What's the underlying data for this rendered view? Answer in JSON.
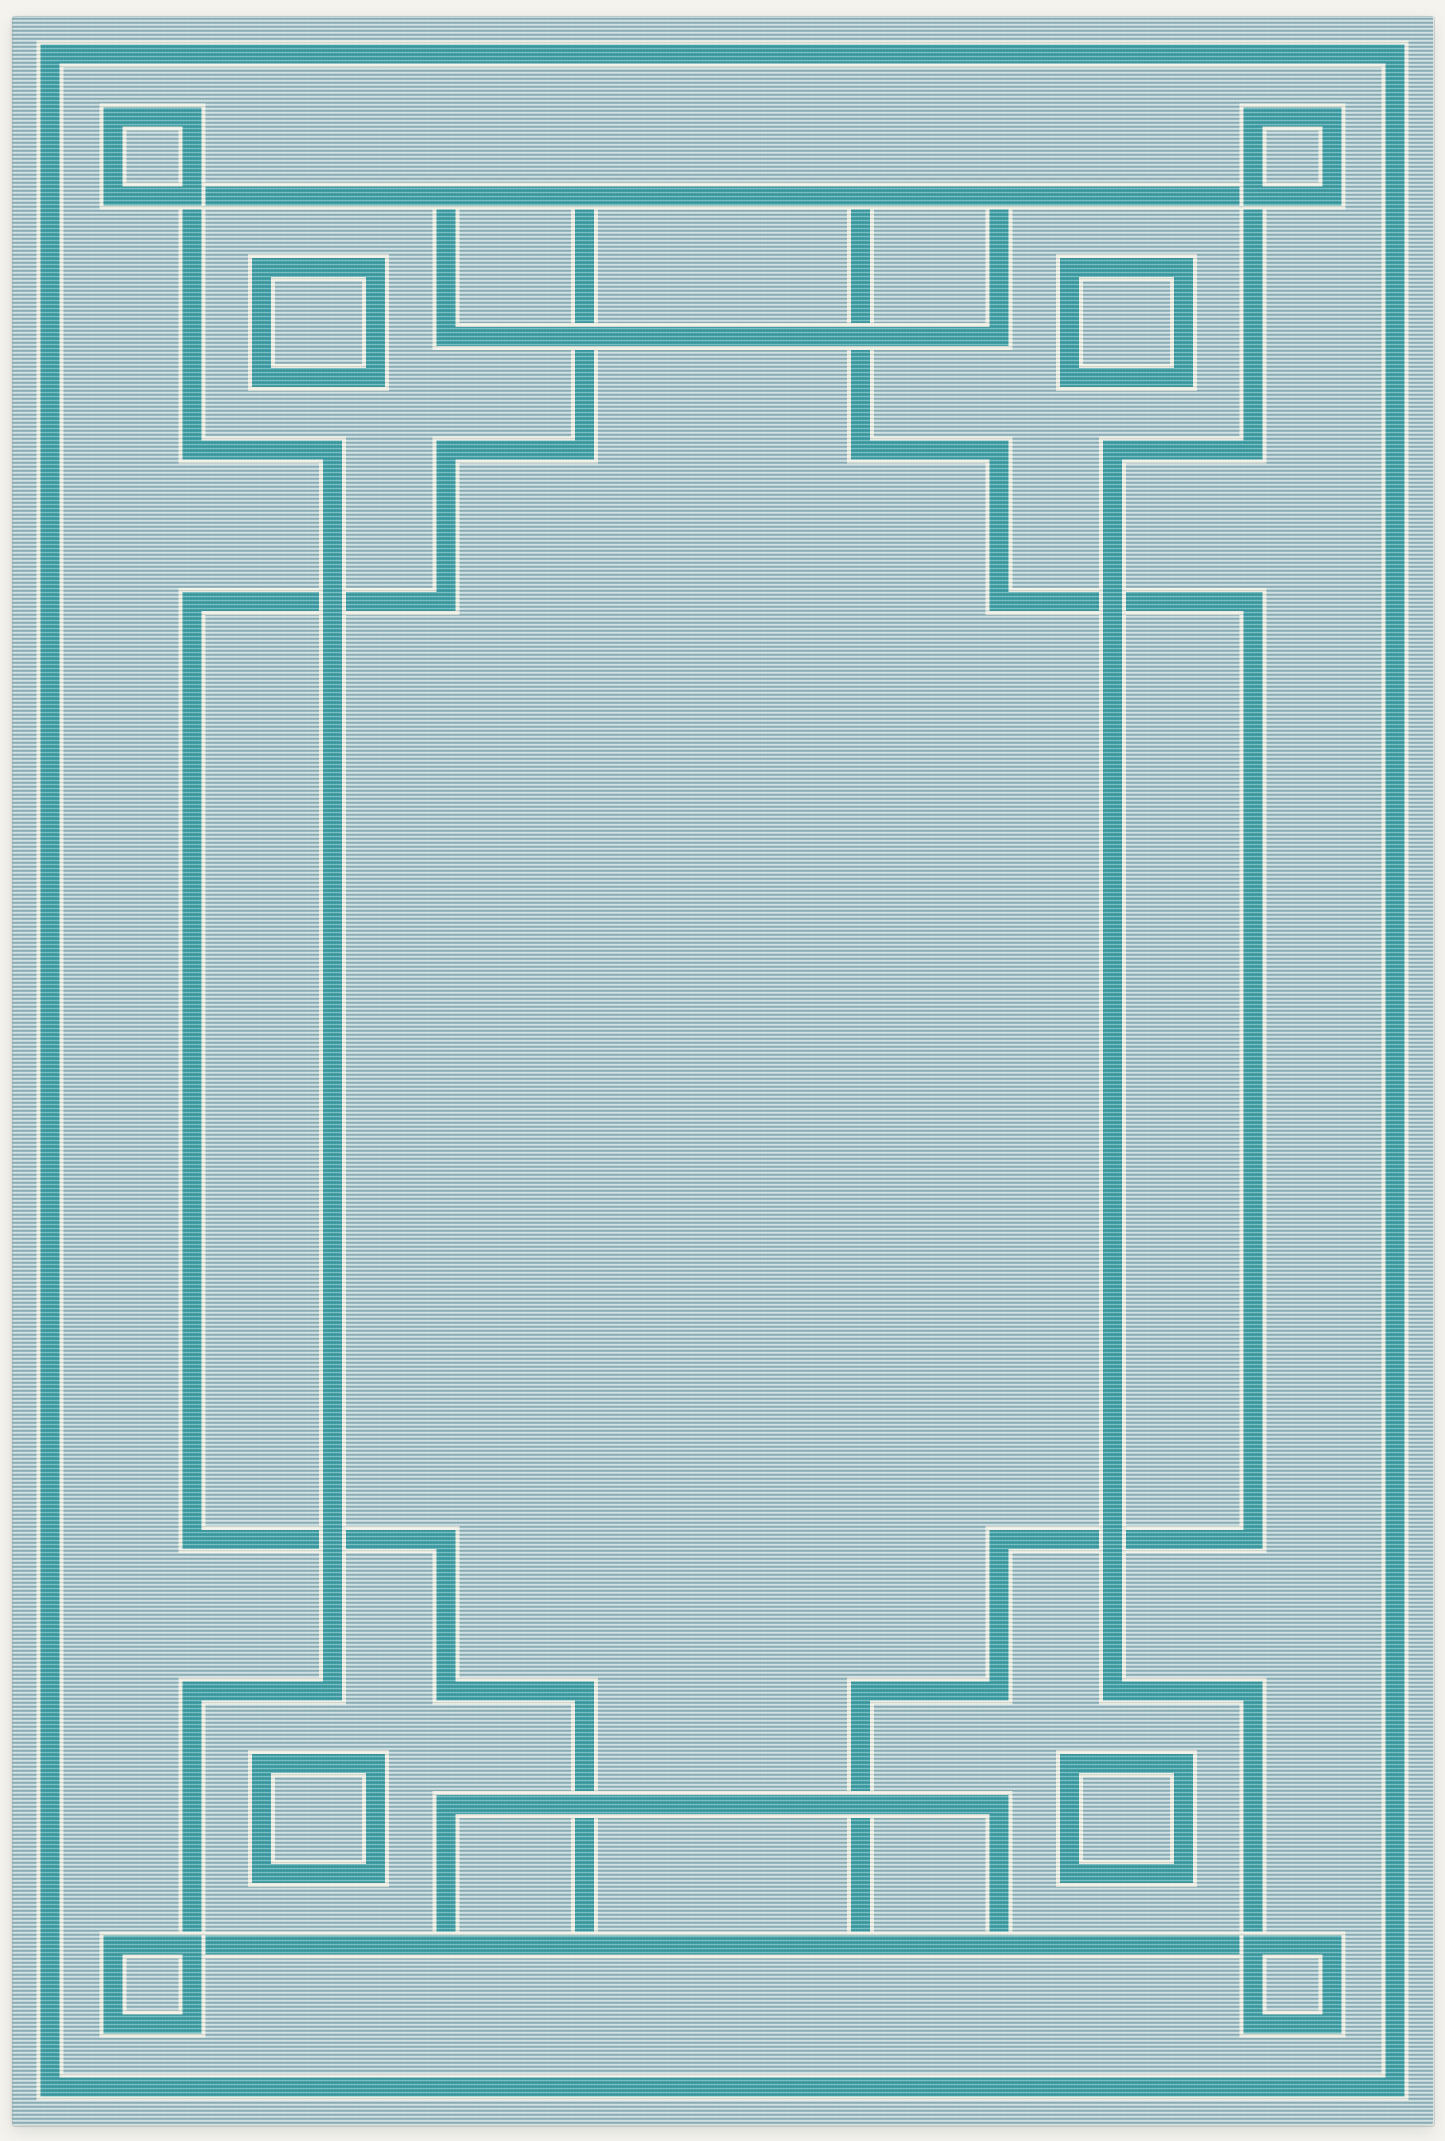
{
  "canvas": {
    "width": 1445,
    "height": 2141
  },
  "colors": {
    "page_background": "#f5f3ee",
    "field_base": "#abc8cd",
    "field_light_rib": "#bdd3d7",
    "field_dark_rib": "#9cbcc3",
    "band_teal": "#3fa0a6",
    "pinstripe_white": "#eff0e5"
  },
  "rug": {
    "left": 12,
    "top": 16,
    "width": 1421,
    "height": 2109,
    "corner_radius": 3
  },
  "pattern": {
    "band_width": 19,
    "pinstripe_width": 4,
    "elements": [
      {
        "name": "outer-thin-frame",
        "type": "path",
        "d": "M 50 54 H 1395 V 2087 H 50 Z"
      },
      {
        "name": "fret-left-inner-line",
        "type": "path",
        "d": "M 584.5 196 V 450 H 446 V 601.5 H 192 V 1539.5 H 446 V 1691 H 584.5 V 1945"
      },
      {
        "name": "fret-right-inner-line",
        "type": "path",
        "d": "M 860.5 196 V 450 H 999 V 601.5 H 1253 V 1539.5 H 999 V 1691 H 860.5 V 1945"
      },
      {
        "name": "fret-left-second-line",
        "type": "path",
        "d": "M 192 117 V 450 H 332.5 V 1691 H 192 V 2024"
      },
      {
        "name": "fret-right-second-line",
        "type": "path",
        "d": "M 1253 117 V 450 H 1112.5 V 1691 H 1253 V 2024"
      },
      {
        "name": "fret-top-second-line",
        "type": "path",
        "d": "M 446 196 V 336.5 H 999 V 196"
      },
      {
        "name": "fret-bottom-second-line",
        "type": "path",
        "d": "M 446 1945 V 1804.5 H 999 V 1945"
      },
      {
        "name": "main-frame-top-band",
        "type": "path",
        "d": "M 104 196 H 1341"
      },
      {
        "name": "main-frame-bottom-band",
        "type": "path",
        "d": "M 104 1945 H 1341"
      },
      {
        "name": "corner-square-top-left",
        "type": "rect",
        "x": 113,
        "y": 117,
        "w": 79,
        "h": 79
      },
      {
        "name": "corner-square-top-right",
        "type": "rect",
        "x": 1253,
        "y": 117,
        "w": 79,
        "h": 79
      },
      {
        "name": "corner-square-bottom-left",
        "type": "rect",
        "x": 113,
        "y": 1945,
        "w": 79,
        "h": 79
      },
      {
        "name": "corner-square-bottom-right",
        "type": "rect",
        "x": 1253,
        "y": 1945,
        "w": 79,
        "h": 79
      },
      {
        "name": "motif-square-top-left",
        "type": "rect",
        "x": 261.5,
        "y": 267.5,
        "w": 114,
        "h": 110
      },
      {
        "name": "motif-square-top-right",
        "type": "rect",
        "x": 1069.5,
        "y": 267.5,
        "w": 114,
        "h": 110
      },
      {
        "name": "motif-square-bottom-left",
        "type": "rect",
        "x": 261.5,
        "y": 1763.5,
        "w": 114,
        "h": 110
      },
      {
        "name": "motif-square-bottom-right",
        "type": "rect",
        "x": 1069.5,
        "y": 1763.5,
        "w": 114,
        "h": 110
      }
    ]
  }
}
